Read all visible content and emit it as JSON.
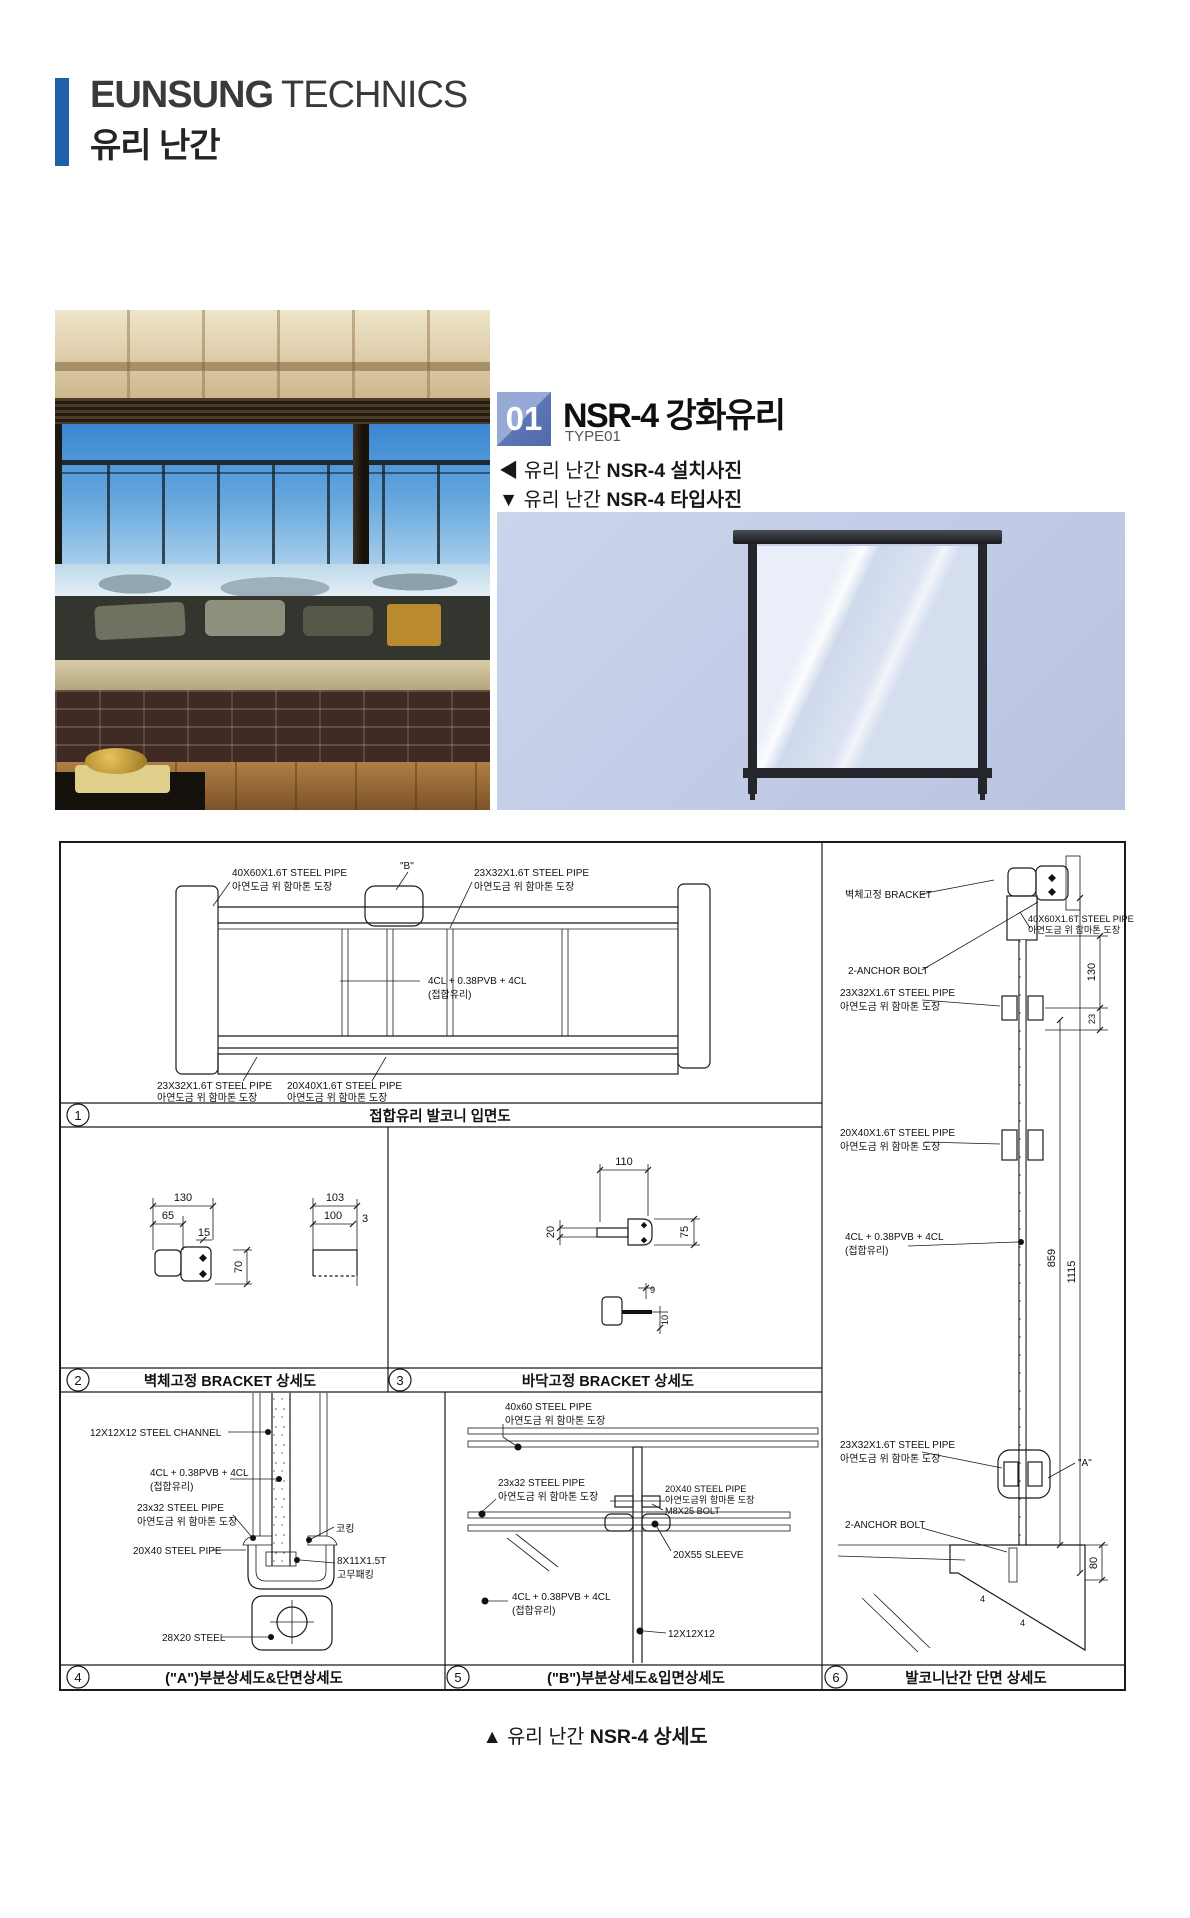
{
  "colors": {
    "accent_bar": "#2060a8",
    "badge_light": "#97aad6",
    "badge_dark": "#4f69aa",
    "diagram_bg": "#c3cce6",
    "line": "#1a1a1a"
  },
  "header": {
    "brand_bold": "EUNSUNG",
    "brand_light": "TECHNICS",
    "subtitle": "유리 난간"
  },
  "section": {
    "number": "01",
    "title": "NSR-4 강화유리",
    "type_label": "TYPE01",
    "caption_install": {
      "marker": "◀",
      "normal": "유리 난간 ",
      "bold": "NSR-4 설치사진"
    },
    "caption_type": {
      "marker": "▼",
      "normal": "유리 난간 ",
      "bold": "NSR-4 타입사진"
    }
  },
  "footer": {
    "marker": "▲",
    "normal": "유리 난간 ",
    "bold": "NSR-4 상세도"
  },
  "sheet": {
    "captions": [
      {
        "no": "1",
        "text": "접합유리 발코니 입면도"
      },
      {
        "no": "2",
        "text": "벽체고정 BRACKET 상세도"
      },
      {
        "no": "3",
        "text": "바닥고정 BRACKET 상세도"
      },
      {
        "no": "4",
        "text": "(\"A\")부분상세도&단면상세도"
      },
      {
        "no": "5",
        "text": "(\"B\")부분상세도&입면상세도"
      },
      {
        "no": "6",
        "text": "발코니난간 단면 상세도"
      }
    ],
    "p1": {
      "lbl_top_rail": [
        "40X60X1.6T STEEL PIPE",
        "아연도금 위 함마톤 도장"
      ],
      "lbl_b": "\"B\"",
      "lbl_mid_rail": [
        "23X32X1.6T STEEL PIPE",
        "아연도금 위 함마톤 도장"
      ],
      "lbl_glass": [
        "4CL + 0.38PVB + 4CL",
        "(접합유리)"
      ],
      "lbl_bottom_rail": [
        "23X32X1.6T STEEL PIPE",
        "아연도금 위 함마톤 도장"
      ],
      "lbl_bottom_rail2": [
        "20X40X1.6T STEEL PIPE",
        "아연도금 위 함마톤 도장"
      ]
    },
    "p2": {
      "dim_130": "130",
      "dim_65": "65",
      "dim_15": "15",
      "dim_70": "70",
      "dim_103": "103",
      "dim_100": "100",
      "dim_3": "3"
    },
    "p3": {
      "dim_110": "110",
      "dim_20": "20",
      "dim_75": "75",
      "dim_9": "9",
      "dim_10": "10"
    },
    "p4": {
      "lbl_channel": "12X12X12 STEEL CHANNEL",
      "lbl_glass": [
        "4CL + 0.38PVB + 4CL",
        "(접합유리)"
      ],
      "lbl_23x32": [
        "23x32 STEEL PIPE",
        "아연도금 위 함마톤 도장"
      ],
      "lbl_20x40": "20X40 STEEL PIPE",
      "lbl_28x20": "28X20 STEEL",
      "lbl_caulk": "코킹",
      "lbl_rubber": [
        "8X11X1.5T",
        "고무패킹"
      ]
    },
    "p5": {
      "lbl_40x60": [
        "40x60 STEEL PIPE",
        "아연도금 위 함마톤 도장"
      ],
      "lbl_23x32": [
        "23x32 STEEL PIPE",
        "아연도금 위 함마톤 도장"
      ],
      "lbl_bolt": [
        "20X40 STEEL PIPE",
        "아연도금위 함마톤 도장",
        "M8X25 BOLT"
      ],
      "lbl_sleeve": "20X55 SLEEVE",
      "lbl_glass": [
        "4CL + 0.38PVB + 4CL",
        "(접합유리)"
      ],
      "lbl_12": "12X12X12"
    },
    "p6": {
      "lbl_bracket": "벽체고정 BRACKET",
      "lbl_40x60": [
        "40X60X1.6T STEEL PIPE",
        "아연도금 위 함마톤 도장"
      ],
      "lbl_anchor_top": "2-ANCHOR BOLT",
      "lbl_23x32_top": [
        "23X32X1.6T STEEL PIPE",
        "아연도금 위 함마톤 도장"
      ],
      "lbl_20x40": [
        "20X40X1.6T STEEL PIPE",
        "아연도금 위 함마톤 도장"
      ],
      "lbl_glass": [
        "4CL + 0.38PVB + 4CL",
        "(접합유리)"
      ],
      "lbl_23x32_bot": [
        "23X32X1.6T STEEL PIPE",
        "아연도금 위 함마톤 도장"
      ],
      "lbl_a": "\"A\"",
      "lbl_anchor_bot": "2-ANCHOR BOLT",
      "dim_130": "130",
      "dim_23": "23",
      "dim_859": "859",
      "dim_1115": "1115",
      "dim_80": "80",
      "mark_4a": "4",
      "mark_4b": "4"
    }
  }
}
